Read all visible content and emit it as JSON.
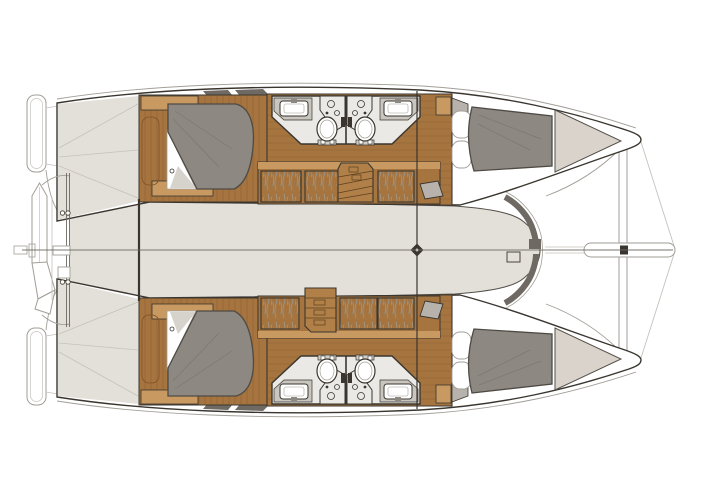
{
  "image": {
    "description": "Top-view interior deck plan of a sailing catamaran with four double cabins and four bathrooms; bow to the right, stern with dinghy davits to the left; no text labels are printed on the drawing.",
    "text_labels": []
  },
  "colors": {
    "background": "#ffffff",
    "outline": "#3a362f",
    "deck": "#e3dfd9",
    "deck_edge": "#55504a",
    "dark_trim": "#6e6962",
    "line_light": "#a29e97",
    "line_faint": "#c6c2bb",
    "wood_floor": "#a5743f",
    "wood_plank": "#7e5128",
    "wood_trim": "#c89a62",
    "wood_stairs": "#b08048",
    "stairs_line": "#5d3f1f",
    "duvet": "#8e8882",
    "duvet_outline": "#4e4a44",
    "crease": "#77726b",
    "linen": "#ffffff",
    "linen_shadow": "#d2cec8",
    "bath_floor": "#ebe9e5",
    "counter": "#c9c5bf",
    "fixture": "#ffffff",
    "wardrobe": "#f7f6f4",
    "hanger": "#9b978f",
    "seat": "#b7b2ab",
    "bow_locker": "#d9d3cb"
  },
  "plan": {
    "type": "floor-plan",
    "orientation": {
      "bow": "right",
      "stern": "left"
    },
    "hulls": [
      {
        "id": "upper-hull",
        "rooms": [
          {
            "type": "double-cabin",
            "position": "aft",
            "berths": 1
          },
          {
            "type": "bathroom",
            "position": "midship-aft",
            "toilet": 1,
            "sink": 1,
            "shower": 1
          },
          {
            "type": "bathroom",
            "position": "midship-forward",
            "toilet": 1,
            "sink": 1,
            "shower": 1
          },
          {
            "type": "double-cabin",
            "position": "forward",
            "berths": 1
          }
        ],
        "wardrobes": 3,
        "staircase": 1
      },
      {
        "id": "lower-hull",
        "rooms": [
          {
            "type": "double-cabin",
            "position": "aft",
            "berths": 1
          },
          {
            "type": "bathroom",
            "position": "midship-aft",
            "toilet": 1,
            "sink": 1,
            "shower": 1
          },
          {
            "type": "bathroom",
            "position": "midship-forward",
            "toilet": 1,
            "sink": 1,
            "shower": 1
          },
          {
            "type": "double-cabin",
            "position": "forward",
            "berths": 1
          }
        ],
        "wardrobes": 3,
        "staircase": 1
      }
    ],
    "center_structures": {
      "saloon_bridgedeck": true,
      "mast_and_main_beam": true,
      "forward_crossbeam": true,
      "bowsprit": true,
      "stern_davits_with_dinghy": true,
      "swim_platforms": 2,
      "anchor_windlass": true
    }
  }
}
